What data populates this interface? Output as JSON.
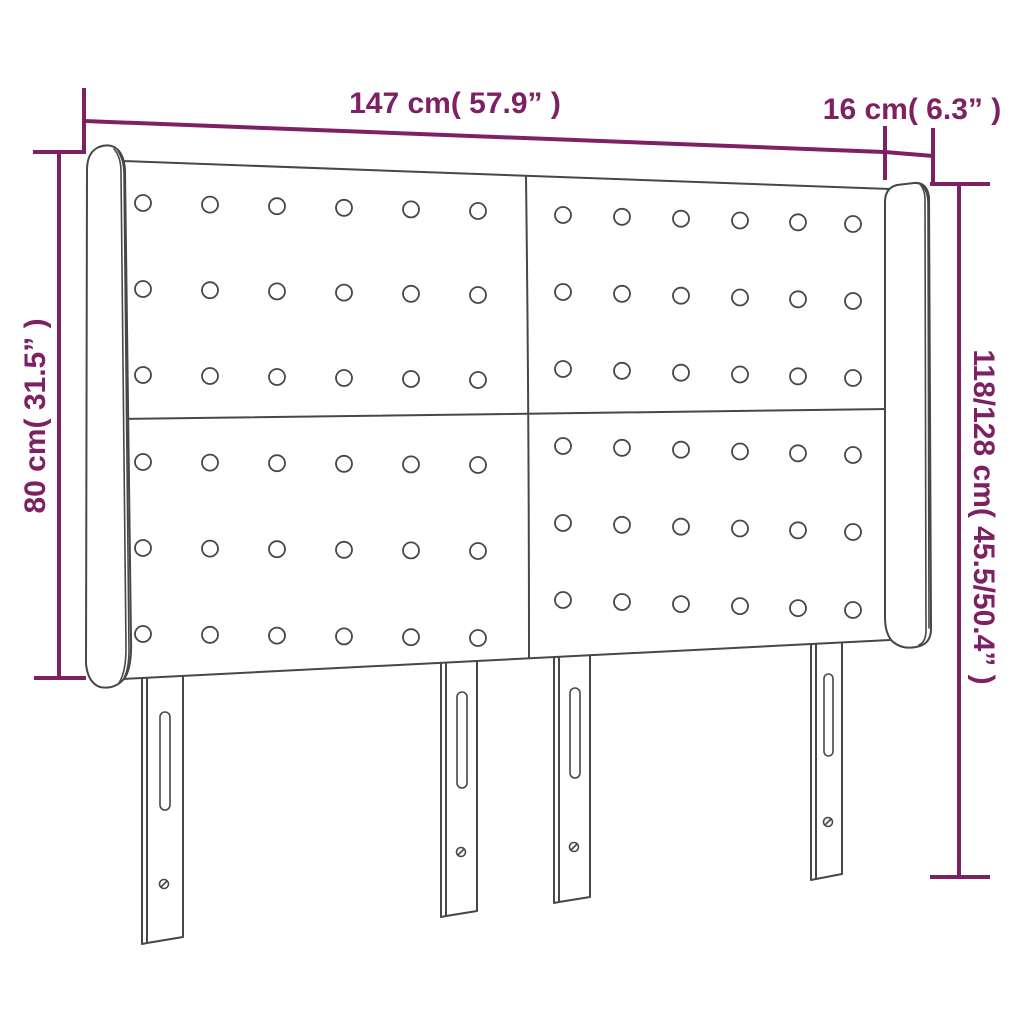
{
  "diagram": {
    "dimensions": {
      "width_label": "147 cm( 57.9” )",
      "depth_label": "16 cm( 6.3” )",
      "height_front_label": "80 cm( 31.5” )",
      "height_total_label": "118/128 cm( 45.5/50.4” )"
    },
    "colors": {
      "dimension_lines": "#7D2164",
      "drawing_outline": "#474747",
      "background": "#FFFFFF"
    }
  }
}
